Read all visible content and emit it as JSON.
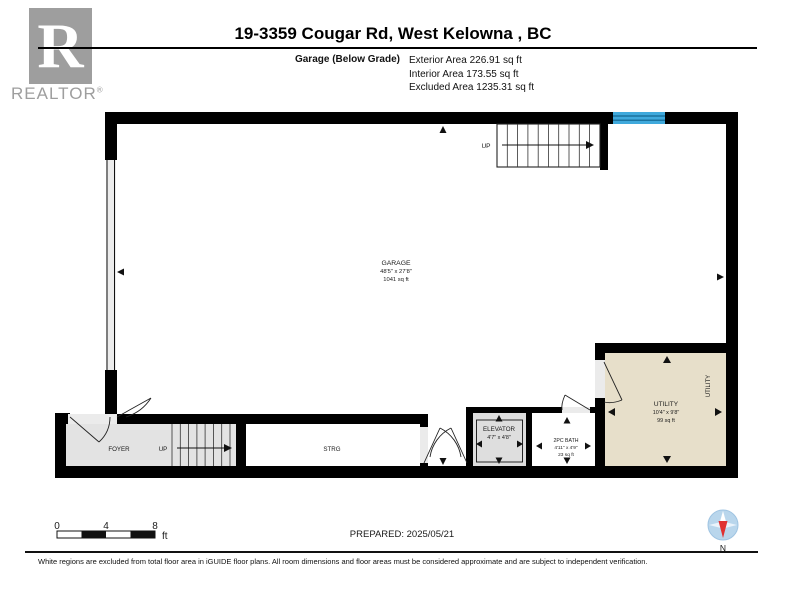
{
  "header": {
    "logo_r": "R",
    "logo_text": "REALTOR",
    "logo_registered": "®",
    "title": "19-3359 Cougar Rd, West Kelowna , BC",
    "floor_label": "Garage (Below Grade)",
    "stats": [
      "Exterior Area 226.91 sq ft",
      "Interior Area 173.55 sq ft",
      "Excluded Area 1235.31 sq ft"
    ]
  },
  "plan": {
    "rooms": [
      {
        "name": "GARAGE",
        "dims": "48'5\" x 27'8\"",
        "area": "1041 sq ft"
      },
      {
        "name": "FOYER"
      },
      {
        "name": "STRG"
      },
      {
        "name": "ELEVATOR",
        "dims": "4'7\" x 4'8\""
      },
      {
        "name": "2PC BATH",
        "dims": "4'11\" x 4'9\"",
        "area": "23 sq ft"
      },
      {
        "name": "UTILITY",
        "dims": "10'4\" x 9'8\"",
        "area": "99 sq ft",
        "side_label": "UTILITY"
      }
    ],
    "stairs": {
      "top_label": "UP",
      "bottom_label": "UP"
    }
  },
  "footer": {
    "scale_ticks": [
      "0",
      "4",
      "8"
    ],
    "scale_unit": "ft",
    "prepared": "PREPARED: 2025/05/21",
    "compass_label": "N",
    "disclaimer": "White regions are excluded from total floor area in iGUIDE floor plans. All room dimensions and floor areas must be considered approximate and are subject to independent verification."
  },
  "colors": {
    "wall": "#000000",
    "excluded_gray": "#e3e3e3",
    "elevator_gray": "#dedede",
    "utility_beige": "#e7dfca",
    "window_blue": "#3fa9dc",
    "window_stripe": "#1b739f",
    "compass_blue": "#b9d6ec",
    "compass_red": "#e03131",
    "logo_gray": "#9e9e9e"
  }
}
